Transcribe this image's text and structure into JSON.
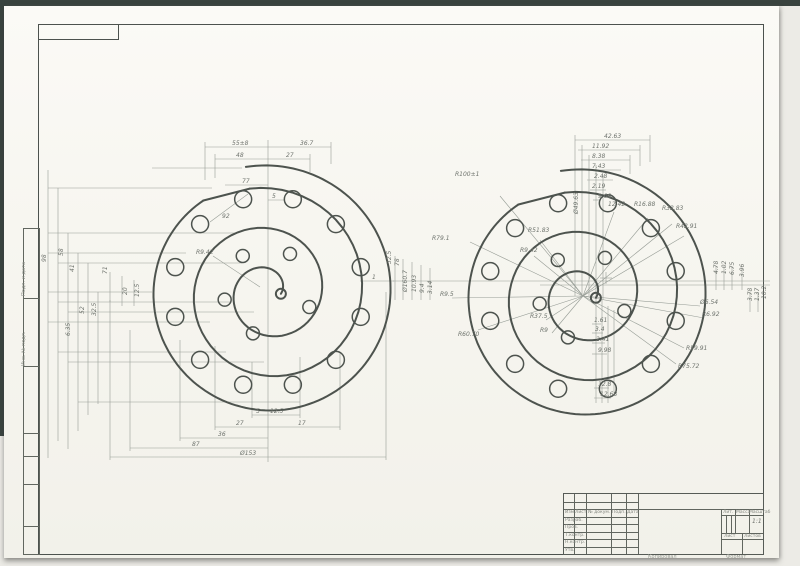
{
  "colors": {
    "paper": "#f7f6f0",
    "wall_line": "#4d534e",
    "thin_line": "#979d96",
    "dark_edge": "#39433f",
    "label": "#6f746e"
  },
  "margin_labels": [
    "Подп. и дата",
    "Инв. № подл."
  ],
  "title_block": {
    "cols": [
      "Изм.",
      "Лист",
      "№ докум.",
      "Подп.",
      "Дата"
    ],
    "rows": [
      "Разраб.",
      "Пров.",
      "Т.контр.",
      "Н.контр.",
      "Утв."
    ],
    "lit": "Лит.",
    "mass": "Масса",
    "scale_label": "Масштаб",
    "scale": "1:1",
    "sheet": "Лист",
    "sheets": "Листов"
  },
  "footer": {
    "left": "Копировал",
    "right": "Формат"
  },
  "drawing": {
    "scrolls": [
      {
        "cx": 268,
        "cy": 292,
        "outer": {
          "r0": 127,
          "r1": 112,
          "a0": -100,
          "turns": 0.93
        },
        "inner": {
          "r0": 105,
          "r1": 13,
          "a0": -100,
          "turns": 2.3
        },
        "ring": {
          "r": 96,
          "hole_r": 8.5,
          "angles": [
            -75,
            -45,
            -15,
            15,
            45,
            75,
            105,
            135,
            165,
            195,
            225,
            255
          ]
        },
        "inner_holes": {
          "r": 44,
          "hole_r": 6.5,
          "angles": [
            110,
            170,
            235,
            300,
            20
          ]
        }
      },
      {
        "cx": 583,
        "cy": 296,
        "outer": {
          "r0": 127,
          "r1": 112,
          "a0": -100,
          "turns": 0.93
        },
        "inner": {
          "r0": 105,
          "r1": 13,
          "a0": -100,
          "turns": 2.3
        },
        "ring": {
          "r": 96,
          "hole_r": 8.5,
          "angles": [
            -75,
            -45,
            -15,
            15,
            45,
            75,
            105,
            135,
            165,
            195,
            225,
            255
          ]
        },
        "inner_holes": {
          "r": 44,
          "hole_r": 6.5,
          "angles": [
            110,
            170,
            235,
            300,
            20
          ]
        },
        "spokes": [
          [
            470,
            242
          ],
          [
            500,
            196
          ],
          [
            540,
            240
          ],
          [
            534,
            256
          ],
          [
            452,
            298
          ],
          [
            478,
            330
          ],
          [
            546,
            320
          ],
          [
            552,
            333
          ],
          [
            614,
            212
          ],
          [
            648,
            218
          ],
          [
            672,
            224
          ],
          [
            684,
            236
          ],
          [
            700,
            306
          ],
          [
            704,
            318
          ],
          [
            684,
            348
          ],
          [
            676,
            364
          ]
        ],
        "cross": [
          606,
          278
        ]
      }
    ],
    "lines": [
      [
        205,
        147,
        331,
        147
      ],
      [
        215,
        159,
        310,
        159
      ],
      [
        225,
        185,
        268,
        185
      ],
      [
        268,
        200,
        285,
        200
      ],
      [
        205,
        142,
        205,
        180
      ],
      [
        331,
        142,
        331,
        164
      ],
      [
        215,
        154,
        215,
        178
      ],
      [
        310,
        154,
        310,
        172
      ],
      [
        268,
        140,
        268,
        462
      ],
      [
        152,
        168,
        242,
        168
      ],
      [
        48,
        188,
        212,
        188
      ],
      [
        48,
        233,
        236,
        233
      ],
      [
        48,
        253,
        186,
        253
      ],
      [
        58,
        263,
        242,
        263
      ],
      [
        48,
        292,
        152,
        292
      ],
      [
        58,
        302,
        230,
        302
      ],
      [
        68,
        312,
        254,
        312
      ],
      [
        48,
        322,
        210,
        322
      ],
      [
        58,
        352,
        226,
        352
      ],
      [
        68,
        362,
        264,
        362
      ],
      [
        78,
        402,
        300,
        402
      ],
      [
        48,
        170,
        48,
        458
      ],
      [
        58,
        188,
        58,
        441
      ],
      [
        68,
        233,
        68,
        449
      ],
      [
        78,
        253,
        78,
        431
      ],
      [
        88,
        263,
        88,
        415
      ],
      [
        98,
        292,
        98,
        404
      ],
      [
        110,
        272,
        110,
        302
      ],
      [
        122,
        276,
        122,
        306
      ],
      [
        134,
        280,
        134,
        306
      ],
      [
        252,
        415,
        300,
        415
      ],
      [
        215,
        427,
        340,
        427
      ],
      [
        180,
        438,
        268,
        438
      ],
      [
        130,
        448,
        268,
        448
      ],
      [
        110,
        457,
        386,
        457
      ],
      [
        252,
        362,
        252,
        418
      ],
      [
        300,
        357,
        300,
        418
      ],
      [
        215,
        346,
        215,
        430
      ],
      [
        340,
        352,
        340,
        430
      ],
      [
        180,
        340,
        180,
        441
      ],
      [
        130,
        330,
        130,
        451
      ],
      [
        110,
        300,
        110,
        460
      ],
      [
        386,
        292,
        386,
        460
      ],
      [
        360,
        281,
        394,
        281
      ],
      [
        395,
        256,
        395,
        300
      ],
      [
        403,
        259,
        403,
        300
      ],
      [
        412,
        262,
        412,
        300
      ],
      [
        421,
        265,
        421,
        300
      ],
      [
        430,
        268,
        430,
        300
      ],
      [
        213,
        256,
        260,
        287
      ],
      [
        210,
        222,
        248,
        194
      ],
      [
        575,
        140,
        650,
        140
      ],
      [
        578,
        150,
        640,
        150
      ],
      [
        581,
        160,
        630,
        160
      ],
      [
        584,
        170,
        621,
        170
      ],
      [
        587,
        180,
        613,
        180
      ],
      [
        590,
        190,
        606,
        190
      ],
      [
        593,
        200,
        601,
        200
      ],
      [
        650,
        135,
        650,
        162
      ],
      [
        640,
        145,
        640,
        166
      ],
      [
        630,
        155,
        630,
        174
      ],
      [
        575,
        135,
        575,
        296
      ],
      [
        582,
        145,
        582,
        296
      ],
      [
        589,
        155,
        589,
        296
      ],
      [
        596,
        165,
        596,
        298
      ],
      [
        603,
        175,
        603,
        300
      ],
      [
        393,
        281,
        770,
        281
      ],
      [
        540,
        285,
        770,
        285
      ],
      [
        592,
        324,
        601,
        324
      ],
      [
        592,
        333,
        603,
        333
      ],
      [
        592,
        343,
        605,
        343
      ],
      [
        592,
        354,
        607,
        354
      ],
      [
        594,
        388,
        609,
        388
      ],
      [
        594,
        398,
        611,
        398
      ],
      [
        596,
        296,
        596,
        403
      ],
      [
        602,
        300,
        602,
        403
      ],
      [
        608,
        306,
        608,
        403
      ],
      [
        614,
        310,
        614,
        393
      ],
      [
        716,
        266,
        716,
        290
      ],
      [
        724,
        266,
        724,
        290
      ],
      [
        732,
        266,
        732,
        290
      ],
      [
        742,
        268,
        742,
        290
      ],
      [
        750,
        292,
        750,
        312
      ],
      [
        758,
        292,
        758,
        312
      ]
    ],
    "labels": [
      {
        "t": "55±8",
        "x": 232,
        "y": 145
      },
      {
        "t": "36.7",
        "x": 300,
        "y": 145
      },
      {
        "t": "48",
        "x": 236,
        "y": 157
      },
      {
        "t": "27",
        "x": 286,
        "y": 157
      },
      {
        "t": "77",
        "x": 242,
        "y": 183
      },
      {
        "t": "5",
        "x": 272,
        "y": 198
      },
      {
        "t": "92",
        "x": 222,
        "y": 218
      },
      {
        "t": "R9.42",
        "x": 196,
        "y": 254
      },
      {
        "t": "5",
        "x": 256,
        "y": 413
      },
      {
        "t": "12.5",
        "x": 270,
        "y": 413
      },
      {
        "t": "27",
        "x": 236,
        "y": 425
      },
      {
        "t": "17",
        "x": 298,
        "y": 425
      },
      {
        "t": "36",
        "x": 218,
        "y": 436
      },
      {
        "t": "87",
        "x": 192,
        "y": 446
      },
      {
        "t": "Ø153",
        "x": 240,
        "y": 455
      },
      {
        "t": "1",
        "x": 372,
        "y": 279
      },
      {
        "t": "98",
        "x": 46,
        "y": 262,
        "v": 1
      },
      {
        "t": "58",
        "x": 63,
        "y": 256,
        "v": 1
      },
      {
        "t": "41",
        "x": 74,
        "y": 272,
        "v": 1
      },
      {
        "t": "71",
        "x": 107,
        "y": 274,
        "v": 1
      },
      {
        "t": "20",
        "x": 127,
        "y": 295,
        "v": 1
      },
      {
        "t": "12.5",
        "x": 139,
        "y": 297,
        "v": 1
      },
      {
        "t": "52",
        "x": 84,
        "y": 314,
        "v": 1
      },
      {
        "t": "32.5",
        "x": 96,
        "y": 316,
        "v": 1
      },
      {
        "t": "6.35",
        "x": 70,
        "y": 336,
        "v": 1
      },
      {
        "t": "32.5",
        "x": 391,
        "y": 264,
        "v": 1
      },
      {
        "t": "78",
        "x": 399,
        "y": 266,
        "v": 1
      },
      {
        "t": "Ø160.7",
        "x": 407,
        "y": 292,
        "v": 1
      },
      {
        "t": "10.93",
        "x": 416,
        "y": 292,
        "v": 1
      },
      {
        "t": "9.4",
        "x": 424,
        "y": 293,
        "v": 1
      },
      {
        "t": "3.14",
        "x": 432,
        "y": 294,
        "v": 1
      },
      {
        "t": "R100±1",
        "x": 455,
        "y": 176
      },
      {
        "t": "R79.1",
        "x": 432,
        "y": 240
      },
      {
        "t": "R51.83",
        "x": 528,
        "y": 232
      },
      {
        "t": "R9.42",
        "x": 520,
        "y": 252
      },
      {
        "t": "R9.5",
        "x": 440,
        "y": 296
      },
      {
        "t": "R60.70",
        "x": 458,
        "y": 336
      },
      {
        "t": "R37.5",
        "x": 530,
        "y": 318
      },
      {
        "t": "R9",
        "x": 540,
        "y": 332
      },
      {
        "t": "42.63",
        "x": 604,
        "y": 138
      },
      {
        "t": "11.92",
        "x": 592,
        "y": 148
      },
      {
        "t": "8.38",
        "x": 592,
        "y": 158
      },
      {
        "t": "7.43",
        "x": 592,
        "y": 168
      },
      {
        "t": "2.48",
        "x": 594,
        "y": 178
      },
      {
        "t": "2.19",
        "x": 592,
        "y": 188
      },
      {
        "t": "9.08",
        "x": 598,
        "y": 198
      },
      {
        "t": "Ø49.63",
        "x": 578,
        "y": 214,
        "v": 1
      },
      {
        "t": "12.42",
        "x": 608,
        "y": 206
      },
      {
        "t": "R16.88",
        "x": 634,
        "y": 206
      },
      {
        "t": "R32.83",
        "x": 662,
        "y": 210
      },
      {
        "t": "R42.91",
        "x": 676,
        "y": 228
      },
      {
        "t": "1.61",
        "x": 594,
        "y": 322
      },
      {
        "t": "3.4",
        "x": 595,
        "y": 331
      },
      {
        "t": "2.41",
        "x": 596,
        "y": 341
      },
      {
        "t": "9.98",
        "x": 598,
        "y": 352
      },
      {
        "t": "12.8",
        "x": 598,
        "y": 386
      },
      {
        "t": "12.68",
        "x": 600,
        "y": 396
      },
      {
        "t": "R59.91",
        "x": 686,
        "y": 350
      },
      {
        "t": "R75.72",
        "x": 678,
        "y": 368
      },
      {
        "t": "Ø6.54",
        "x": 700,
        "y": 304
      },
      {
        "t": "R6.92",
        "x": 702,
        "y": 316
      },
      {
        "t": "4.78",
        "x": 718,
        "y": 274,
        "v": 1
      },
      {
        "t": "1.02",
        "x": 726,
        "y": 274,
        "v": 1
      },
      {
        "t": "6.75",
        "x": 734,
        "y": 275,
        "v": 1
      },
      {
        "t": "3.96",
        "x": 744,
        "y": 277,
        "v": 1
      },
      {
        "t": "3.78",
        "x": 752,
        "y": 301,
        "v": 1
      },
      {
        "t": "1.37",
        "x": 759,
        "y": 301,
        "v": 1
      },
      {
        "t": "10.2",
        "x": 766,
        "y": 299,
        "v": 1
      }
    ]
  }
}
